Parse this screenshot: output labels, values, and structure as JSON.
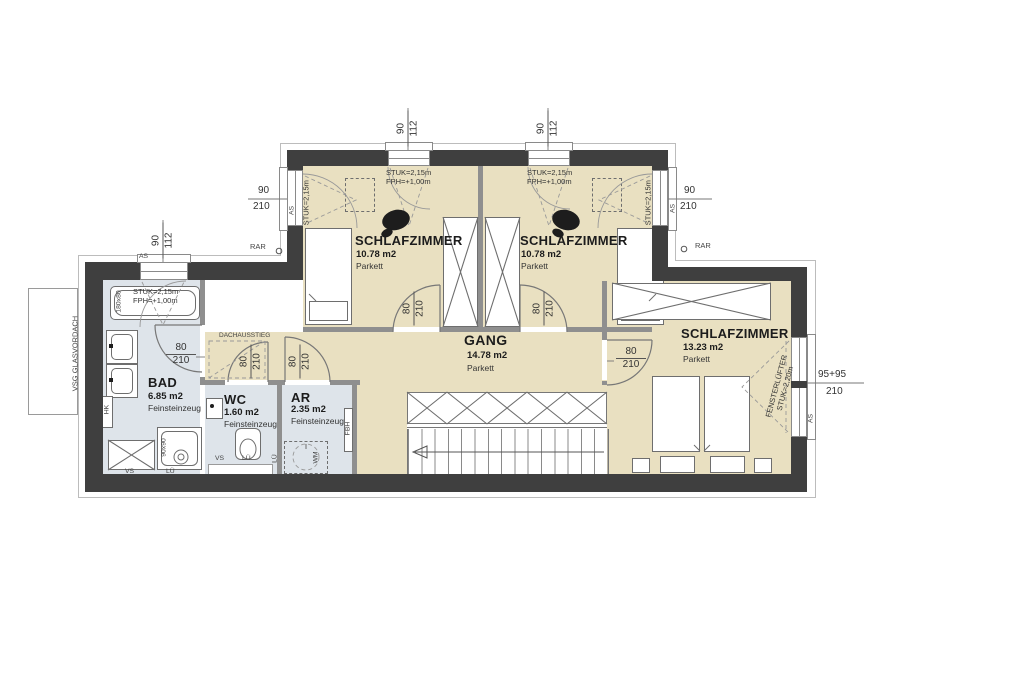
{
  "rooms": {
    "bedroom1": {
      "name": "SCHLAFZIMMER",
      "area": "10.78 m2",
      "floor": "Parkett"
    },
    "bedroom2": {
      "name": "SCHLAFZIMMER",
      "area": "10.78 m2",
      "floor": "Parkett"
    },
    "bedroom3": {
      "name": "SCHLAFZIMMER",
      "area": "13.23 m2",
      "floor": "Parkett"
    },
    "gang": {
      "name": "GANG",
      "area": "14.78 m2",
      "floor": "Parkett"
    },
    "bad": {
      "name": "BAD",
      "area": "6.85 m2",
      "floor": "Feinsteinzeug"
    },
    "wc": {
      "name": "WC",
      "area": "1.60 m2",
      "floor": "Feinsteinzeug"
    },
    "ar": {
      "name": "AR",
      "area": "2.35 m2",
      "floor": "Feinsteinzeug"
    }
  },
  "dims": {
    "win_90_112": {
      "a": "90",
      "b": "112"
    },
    "win_90_210": {
      "a": "90",
      "b": "210"
    },
    "win_95_95_210": {
      "a": "95+95",
      "b": "210"
    },
    "door_80_210": {
      "a": "80",
      "b": "210"
    }
  },
  "notes": {
    "stuk215": "STUK=2,15m",
    "fph100": "FPH=+1,00m",
    "stuk220": "STUK=2,20m",
    "fensterluefter": "FENSTERLÜFTER"
  },
  "labels": {
    "as": "AS",
    "rar": "RAR",
    "vs": "VS",
    "lue": "LÜ",
    "hk": "HK",
    "wm": "WM",
    "fbh": "FBH",
    "glasvordach": "VSG GLASVORDACH",
    "dachausstieg": "DACHAUSSTIEG",
    "bathtub_size": "180x80",
    "shower_size": "90x90"
  },
  "colors": {
    "wall": "#3f3f3f",
    "parquet_floor": "#e9e0c1",
    "tile_floor": "#dee4ea",
    "outline": "#bcbcbc",
    "furniture_stroke": "#6e6e6e"
  }
}
